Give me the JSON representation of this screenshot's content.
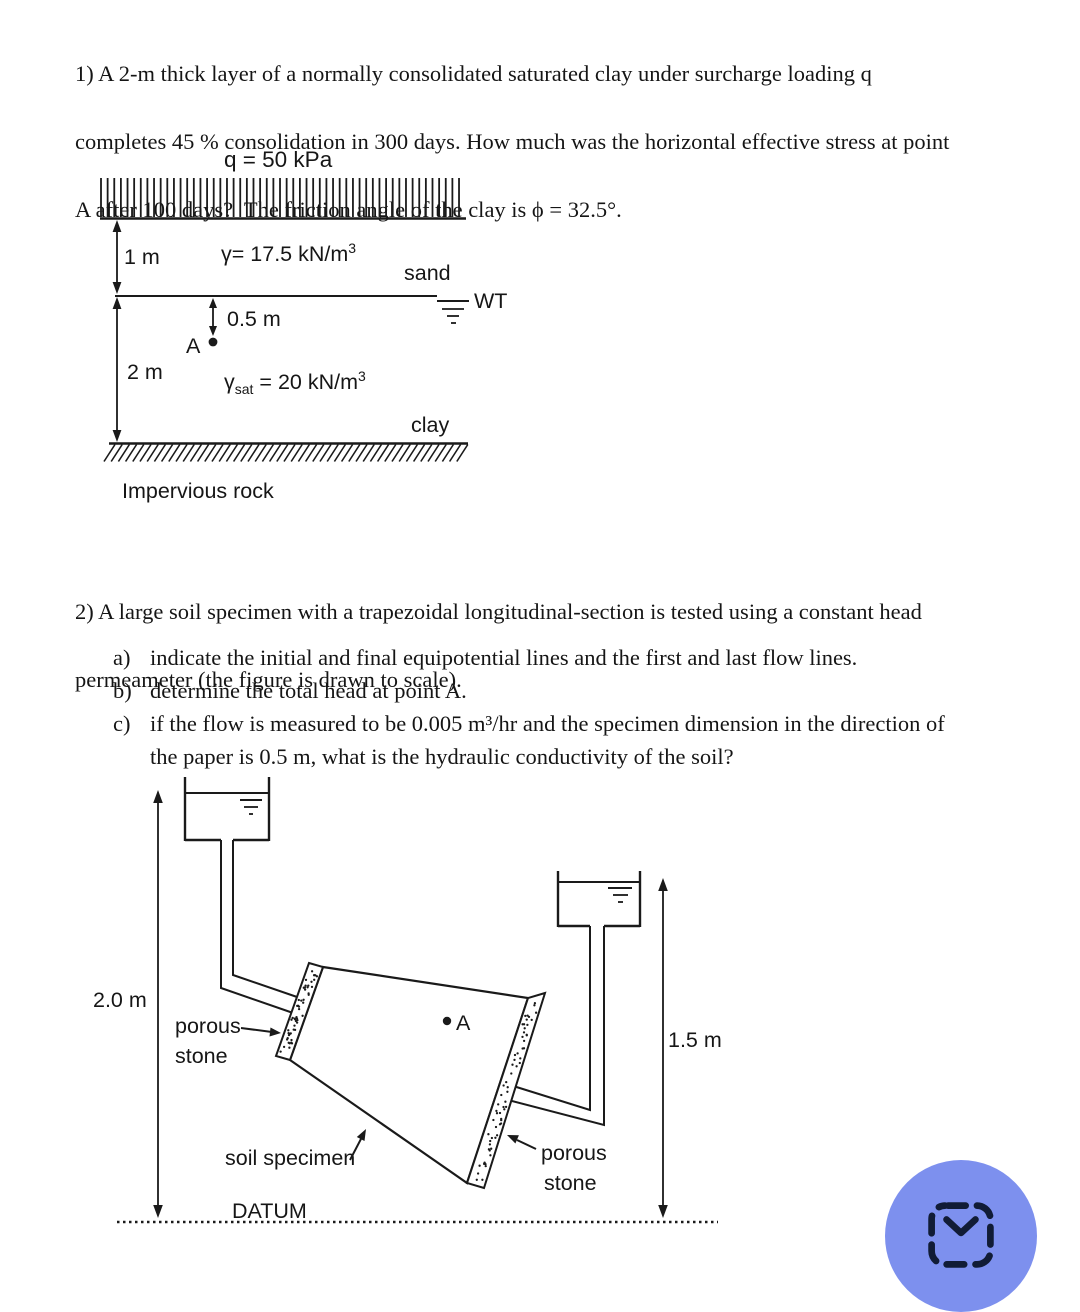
{
  "problem1": {
    "text_lines": [
      "1) A 2-m thick layer of a normally consolidated saturated clay under surcharge loading q",
      "completes 45 % consolidation in 300 days. How much was the horizontal effective stress at point",
      "A after 100 days?  The friction angle of the clay is ϕ = 32.5°."
    ],
    "figure": {
      "surcharge_label": "q = 50 kPa",
      "dim_1m": "1 m",
      "gamma_sand": {
        "base": "γ= 17.5 kN/m",
        "sup": "3"
      },
      "sand_label": "sand",
      "wt_label": "WT",
      "dim_05m": "0.5 m",
      "point_a": "A",
      "dim_2m": "2 m",
      "gamma_clay": {
        "base": "γ",
        "sub": "sat",
        "mid": " = 20 kN/m",
        "sup": "3"
      },
      "clay_label": "clay",
      "rock_label": "Impervious rock"
    }
  },
  "problem2": {
    "text_lines": [
      "2) A large soil specimen with a trapezoidal longitudinal-section is tested using a constant head",
      "permeameter (the figure is drawn to scale)."
    ],
    "items": [
      {
        "marker": "a)",
        "text": "indicate the initial and final equipotential lines and the first and last flow lines."
      },
      {
        "marker": "b)",
        "text": "determine the total head at point A."
      },
      {
        "marker": "c)",
        "text": "if the flow is measured to be 0.005 m³/hr and the specimen dimension in the direction of"
      },
      {
        "marker": "",
        "text": "the paper is 0.5 m, what is the hydraulic conductivity of the soil?"
      }
    ],
    "figure": {
      "dim_left": "2.0 m",
      "dim_right": "1.5 m",
      "porous_left_line1": "porous",
      "porous_left_line2": "stone",
      "porous_right_line1": "porous",
      "porous_right_line2": "stone",
      "soil_label": "soil specimen",
      "point_a": "A",
      "datum_label": "DATUM"
    }
  },
  "fab": {
    "bg_color": "#7d90ee",
    "icon_color": "#111c36"
  }
}
